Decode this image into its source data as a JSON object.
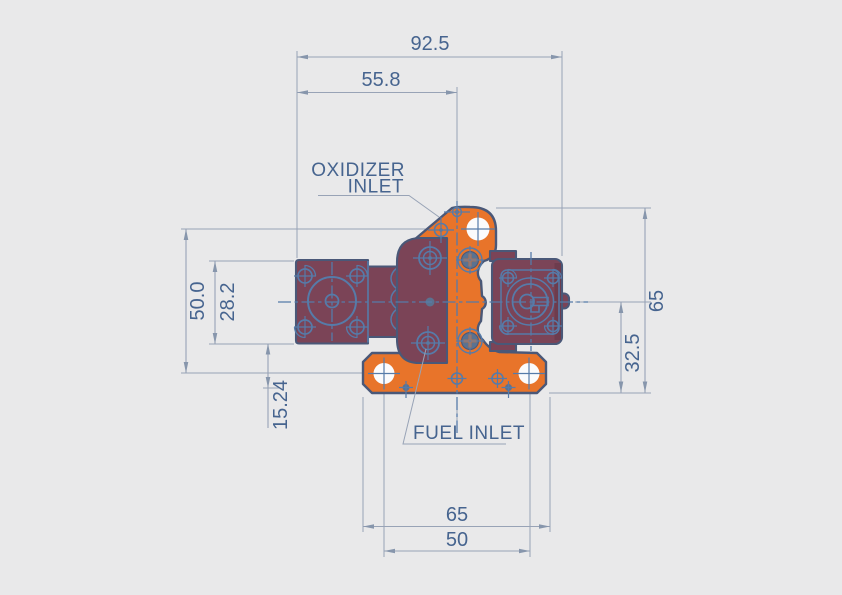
{
  "drawing": {
    "labels": {
      "oxidizer_inlet_line1": "OXIDIZER",
      "oxidizer_inlet_line2": "INLET",
      "fuel_inlet": "FUEL INLET"
    },
    "dimensions": {
      "top_overall_width": "92.5",
      "top_inlet_offset": "55.8",
      "left_hole_span": "50.0",
      "left_flange_height": "28.2",
      "left_lower_offset": "15.24",
      "right_overall_height": "65",
      "right_lower_height": "32.5",
      "bottom_flange_width": "65",
      "bottom_hole_spacing": "50"
    },
    "colors": {
      "background": "#e9e9ea",
      "body_orange": "#e8742a",
      "body_maroon": "#7b4457",
      "outline": "#4a5878",
      "detail_blue": "#567ba9",
      "fastener_steel": "#5b7290",
      "dimension_line": "#98a3b6",
      "dimension_text": "#46648f",
      "hole_white": "#fbfbfc"
    }
  }
}
